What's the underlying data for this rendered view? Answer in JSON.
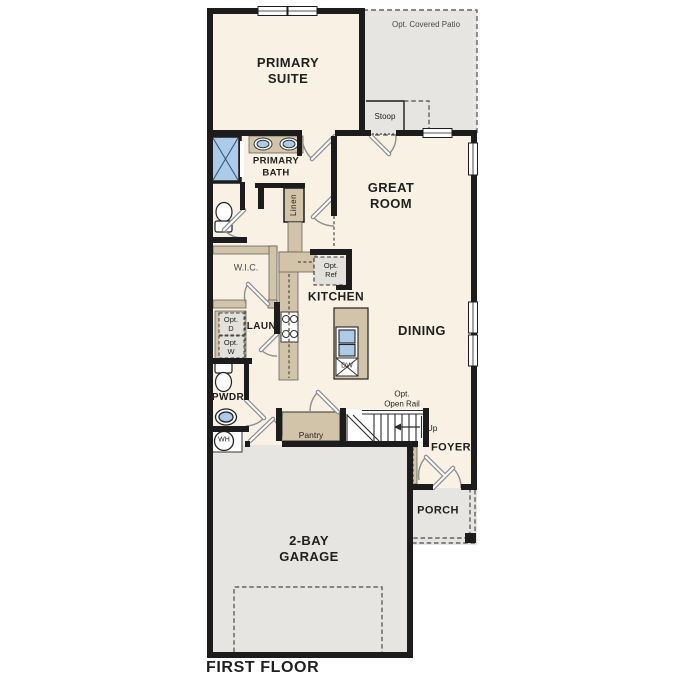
{
  "floor": {
    "title": "FIRST FLOOR"
  },
  "labels": {
    "primary_suite": "PRIMARY\nSUITE",
    "opt_covered_patio": "Opt. Covered Patio",
    "stoop": "Stoop",
    "primary_bath": "PRIMARY\nBATH",
    "linen": "Linen",
    "great_room": "GREAT\nROOM",
    "wic": "W.I.C.",
    "opt_ref": "Opt.\nRef",
    "kitchen": "KITCHEN",
    "dining": "DINING",
    "laundry": "LAUN.",
    "opt_dryer": "Opt.\nD",
    "opt_washer": "Opt.\nW",
    "powder": "PWDR",
    "water_heater": "WH",
    "pantry": "Pantry",
    "opt_open_rail": "Opt.\nOpen Rail",
    "stairs_up": "Up",
    "foyer": "FOYER",
    "porch": "PORCH",
    "garage": "2-BAY\nGARAGE",
    "dishwasher": "DW"
  },
  "fixtures": [
    "shower",
    "double-vanity-sinks",
    "bath-toilet",
    "linen-closet",
    "optional-refrigerator",
    "range-stove",
    "kitchen-island",
    "island-sink",
    "dishwasher",
    "optional-dryer",
    "optional-washer",
    "powder-toilet",
    "powder-sink",
    "water-heater",
    "stairs-up-arrow",
    "garage-door-outline",
    "porch-post",
    "windows",
    "door-swings"
  ],
  "colors": {
    "background": "#ffffff",
    "room-cream": "#f8f1e4",
    "exterior-gray": "#e6e5e2",
    "box-gray": "#e3e1dc",
    "cabinet-tan": "#d2c4a8",
    "fixture-blue": "#abcbe9",
    "wall-black": "#1c1c1c",
    "door-gray": "#8e8e8e",
    "line-dark": "#2a2a2a",
    "dash-gray": "#4a4a4a",
    "label-dark": "#1f1f1f",
    "label-muted": "#4a4a4a"
  }
}
